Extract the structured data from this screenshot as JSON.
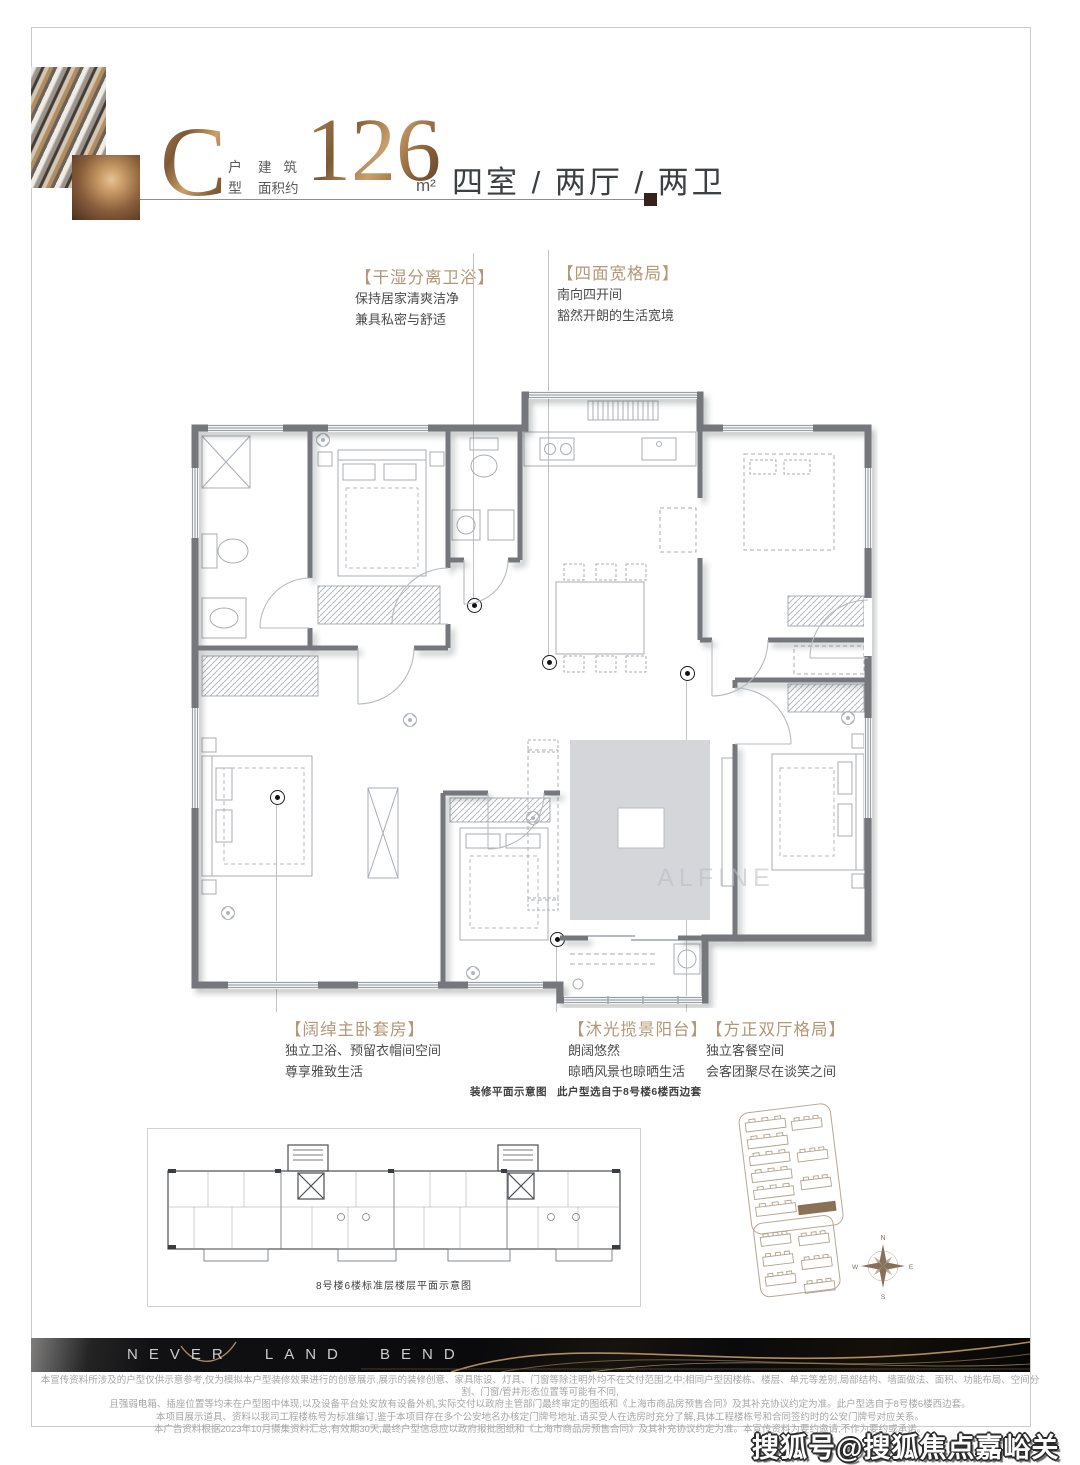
{
  "header": {
    "type_letter": "C",
    "type_char_1": "户",
    "type_char_2": "型",
    "area_label_line1": "建筑",
    "area_label_line2": "面积约",
    "area_value": "126",
    "area_unit": "m²",
    "rooms_text": "四室 / 两厅 / 两卫"
  },
  "callouts": {
    "top": [
      {
        "title": "【干湿分离卫浴】",
        "lines": [
          "保持居家清爽洁净",
          "兼具私密与舒适"
        ]
      },
      {
        "title": "【四面宽格局】",
        "lines": [
          "南向四开间",
          "豁然开朗的生活宽境"
        ]
      }
    ],
    "bottom": [
      {
        "title": "【阔绰主卧套房】",
        "lines": [
          "独立卫浴、预留衣帽间空间",
          "尊享雅致生活"
        ]
      },
      {
        "title": "【沐光揽景阳台】",
        "lines": [
          "朗阔悠然",
          "晾晒风景也晾晒生活"
        ]
      },
      {
        "title": "【方正双厅格局】",
        "lines": [
          "独立客餐空间",
          "会客团聚尽在谈笑之间"
        ]
      }
    ]
  },
  "plan_captions": {
    "left": "装修平面示意图",
    "right": "此户型选自于8号楼6楼西边套"
  },
  "plan_watermark": "ALFINE",
  "floor_caption": "8号楼6楼标准层楼层平面示意图",
  "compass": {
    "n": "N",
    "e": "E",
    "s": "S",
    "w": "W"
  },
  "footer": {
    "brand": "NEVER LAND BEND",
    "disclaimer_lines": [
      "本宣传资料所涉及的户型仅供示意参考,仅为模拟本户型装修效果进行的创意展示,展示的装修创意、家具陈设、灯具、门窗等除注明外均不在交付范围之中;相同户型因楼栋、楼层、单元等差别,局部结构、墙面做法、面积、功能布局、空间分割、门窗/管井形态位置等可能有不同,",
      "且强弱电箱、插座位置等均未在户型图中体现,以及设备平台处安放有设备外机,实际交付以政府主管部门最终审定的图纸和《上海市商品房预售合同》及其补充协议约定为准。此户型选自于8号楼6楼西边套。",
      "本项目展示道具、资料以我司工程楼栋号为标准编订,鉴于本项目存在多个公安地名办核定门牌号地址,请买受人在选房时充分了解,具体工程楼栋号和合同签约时的公安门牌号对应关系。",
      "本广告资料根据2023年10月摄集资料汇总,有效期30天,最终户型信息应以政府报批图纸和《上海市商品房预售合同》及其补充协议约定为准。本宣传资料为要约邀请,不作为要约或承诺。"
    ]
  },
  "watermark": "搜狐号@搜狐焦点嘉峪关站",
  "colors": {
    "bronze": "#a97e4f",
    "callout_title": "#b29878",
    "wall_gray": "#74777d",
    "band_black": "#0a0a0c",
    "band_gold": "#c9a06c",
    "highlight_building": "#8a7055"
  }
}
